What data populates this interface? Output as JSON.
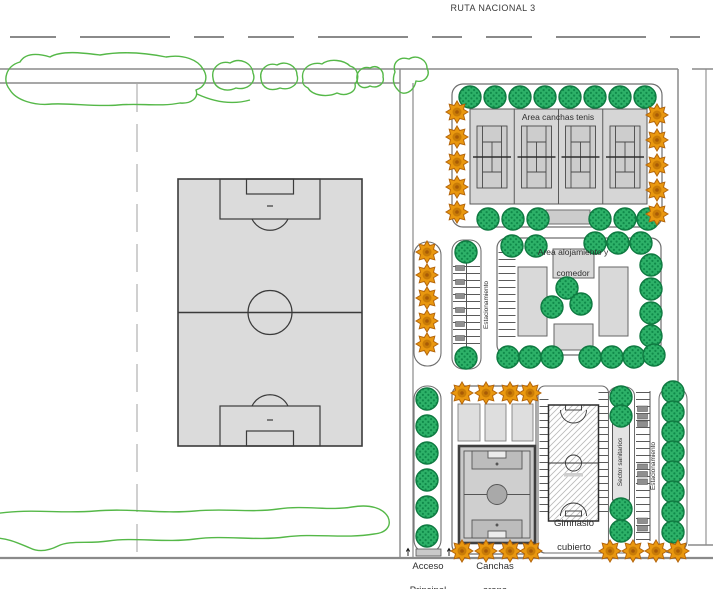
{
  "plan": {
    "road_label": "RUTA NACIONAL 3",
    "areas": {
      "tennis": {
        "label": "Area canchas tenis"
      },
      "lodging": {
        "label_line1": "Area alojamiento y",
        "label_line2": "comedor"
      },
      "parking_mid": {
        "label": "Estacionamiento"
      },
      "parking_right": {
        "label": "Estacionamiento"
      },
      "sanitary": {
        "label": "Sector sanitarios"
      },
      "gym": {
        "label_line1": "Gimnasio",
        "label_line2": "cubierto"
      },
      "access": {
        "label_line1": "Acceso",
        "label_line2": "Principal"
      },
      "sand_courts": {
        "label_line1": "Canchas",
        "label_line2": "arena"
      }
    }
  },
  "colors": {
    "tree_green": "#2db168",
    "tree_green_dark": "#0f8a4a",
    "tree_orange": "#e9980f",
    "vegetation_outline": "#55b848",
    "field_gray": "#dbdbdb",
    "court_gray": "#cdcdcd",
    "road_line": "#8a8a8a",
    "label_text": "#2f2f2f"
  }
}
